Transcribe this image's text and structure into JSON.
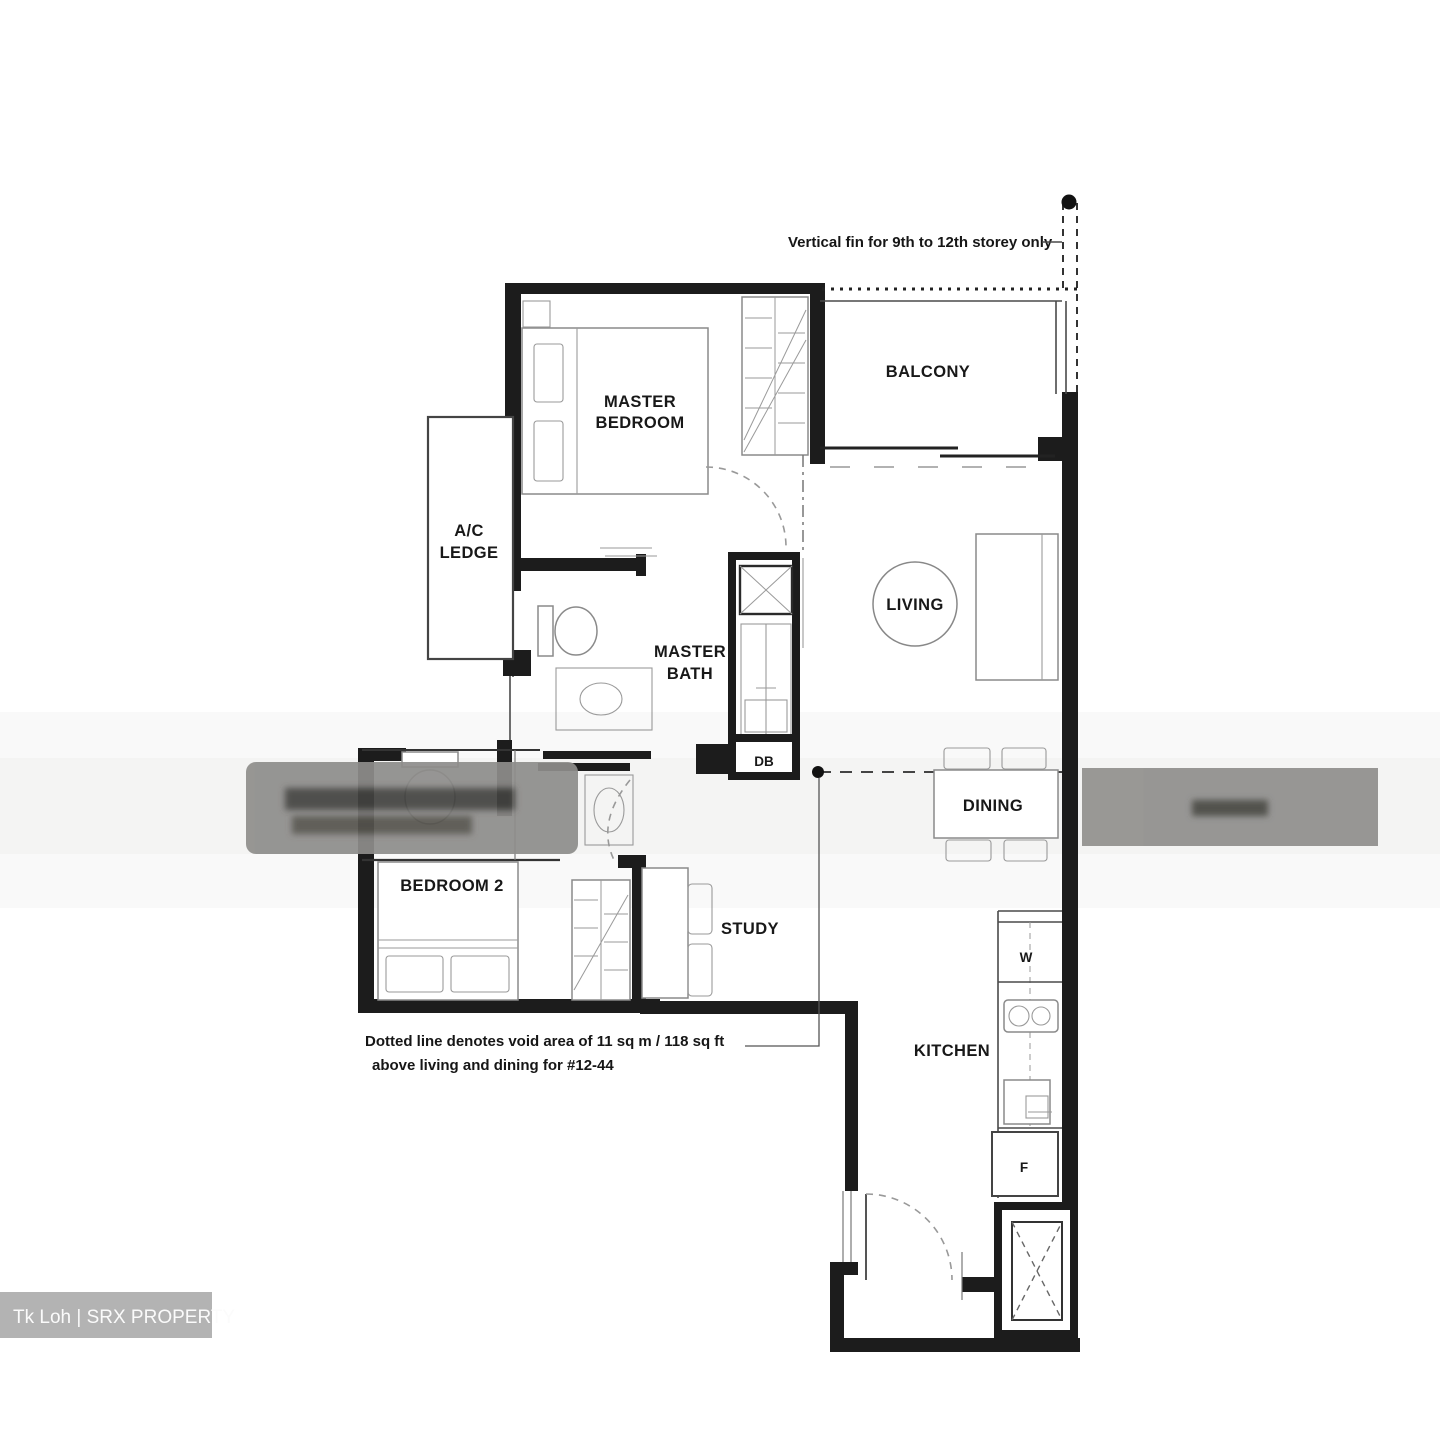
{
  "annotations": {
    "vertical_fin_note": "Vertical fin for 9th to 12th storey only",
    "void_note_line1": "Dotted line denotes void area of 11 sq m / 118 sq ft",
    "void_note_line2": "above living and dining for #12-44"
  },
  "rooms": {
    "master_bedroom": {
      "line1": "MASTER",
      "line2": "BEDROOM"
    },
    "master_bath": {
      "line1": "MASTER",
      "line2": "BATH"
    },
    "ac_ledge": {
      "line1": "A/C",
      "line2": "LEDGE"
    },
    "balcony": {
      "label": "BALCONY"
    },
    "living": {
      "label": "LIVING"
    },
    "dining": {
      "label": "DINING"
    },
    "bedroom2": {
      "label": "BEDROOM 2"
    },
    "study": {
      "label": "STUDY"
    },
    "kitchen": {
      "label": "KITCHEN"
    }
  },
  "fixtures": {
    "db": "DB",
    "washer": "W",
    "fridge": "F"
  },
  "watermark": {
    "credit": "Tk Loh | SRX PROPERTY"
  },
  "colors": {
    "wall": "#1c1c1c",
    "watermark_gray": "#8f8e8c",
    "credit_bg": "#b3b3b3"
  }
}
